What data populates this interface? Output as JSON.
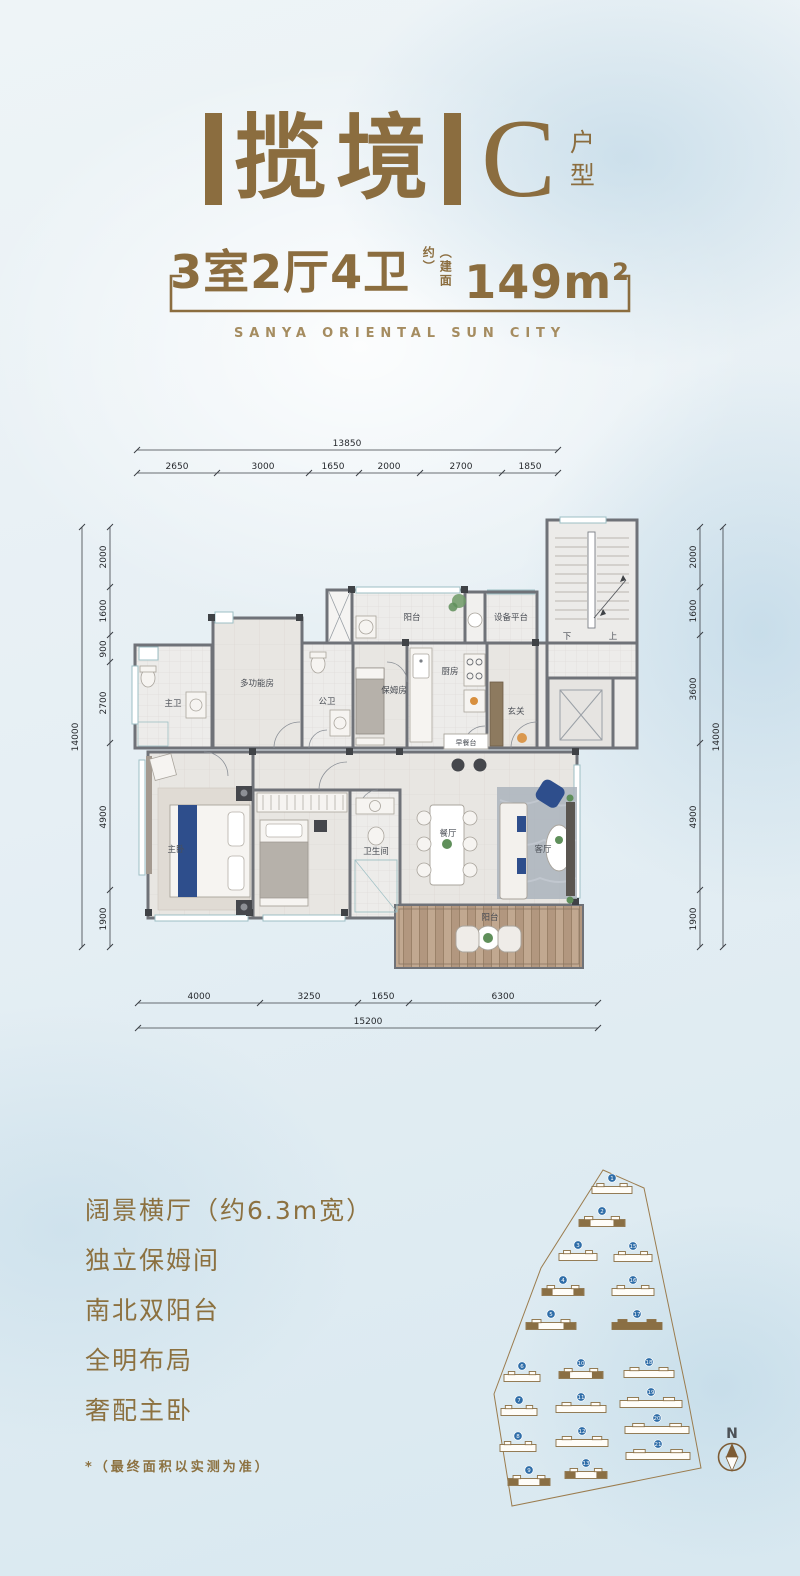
{
  "header": {
    "bracket_left": "【",
    "project_name": "揽境",
    "bracket_right": "】",
    "unit_letter": "C",
    "unit_word_top": "户",
    "unit_word_bottom": "型",
    "rooms_text": "3室2厅4卫",
    "area_note": "（建面约）",
    "area_value": "149m",
    "area_sup": "2",
    "english": "SANYA ORIENTAL SUN CITY"
  },
  "plan": {
    "dims": {
      "top_total": "13850",
      "top_segments": [
        "2650",
        "3000",
        "1650",
        "2000",
        "2700",
        "1850"
      ],
      "bottom_segments": [
        "4000",
        "3250",
        "1650",
        "6300"
      ],
      "bottom_total": "15200",
      "left_total": "14000",
      "left_segments": [
        "2000",
        "1600",
        "900",
        "2700",
        "4900",
        "1900"
      ],
      "right_total": "14000",
      "right_segments": [
        "2000",
        "1600",
        "3600",
        "4900",
        "1900"
      ]
    },
    "rooms": {
      "master_bath": "主卫",
      "multi_room": "多功能房",
      "public_bath": "公卫",
      "nanny_room": "保姆房",
      "north_balcony": "阳台",
      "equipment": "设备平台",
      "kitchen": "厨房",
      "foyer": "玄关",
      "breakfast_bar": "早餐台",
      "stairs_down": "下",
      "stairs_up": "上",
      "master_bed": "主卧",
      "bath3": "卫生间",
      "dining": "餐厅",
      "living": "客厅",
      "south_balcony": "阳台"
    }
  },
  "features": {
    "items": [
      "阔景横厅（约6.3m宽）",
      "独立保姆间",
      "南北双阳台",
      "全明布局",
      "奢配主卧"
    ],
    "footnote": "*（最终面积以实测为准）"
  },
  "siteplan": {
    "compass_label": "N",
    "boundary": [
      [
        123,
        8
      ],
      [
        164,
        26
      ],
      [
        207,
        232
      ],
      [
        221,
        306
      ],
      [
        32,
        344
      ],
      [
        14,
        232
      ],
      [
        61,
        106
      ]
    ],
    "buildings": [
      {
        "n": "1",
        "x": 132,
        "y": 28,
        "w": 40,
        "style": "outline"
      },
      {
        "n": "2",
        "x": 122,
        "y": 61,
        "w": 46,
        "style": "mixed"
      },
      {
        "n": "3",
        "x": 98,
        "y": 95,
        "w": 38,
        "style": "outline"
      },
      {
        "n": "15",
        "x": 153,
        "y": 96,
        "w": 38,
        "style": "outline"
      },
      {
        "n": "4",
        "x": 83,
        "y": 130,
        "w": 42,
        "style": "mixed"
      },
      {
        "n": "16",
        "x": 153,
        "y": 130,
        "w": 42,
        "style": "outline"
      },
      {
        "n": "5",
        "x": 71,
        "y": 164,
        "w": 50,
        "style": "mixed"
      },
      {
        "n": "17",
        "x": 157,
        "y": 164,
        "w": 50,
        "style": "filled"
      },
      {
        "n": "6",
        "x": 42,
        "y": 216,
        "w": 36,
        "style": "outline"
      },
      {
        "n": "10",
        "x": 101,
        "y": 213,
        "w": 44,
        "style": "mixed"
      },
      {
        "n": "18",
        "x": 169,
        "y": 212,
        "w": 50,
        "style": "outline"
      },
      {
        "n": "7",
        "x": 39,
        "y": 250,
        "w": 36,
        "style": "outline"
      },
      {
        "n": "11",
        "x": 101,
        "y": 247,
        "w": 50,
        "style": "outline"
      },
      {
        "n": "19",
        "x": 171,
        "y": 242,
        "w": 62,
        "style": "outline"
      },
      {
        "n": "8",
        "x": 38,
        "y": 286,
        "w": 36,
        "style": "outline"
      },
      {
        "n": "12",
        "x": 102,
        "y": 281,
        "w": 52,
        "style": "outline"
      },
      {
        "n": "20",
        "x": 177,
        "y": 268,
        "w": 64,
        "style": "outline"
      },
      {
        "n": "9",
        "x": 49,
        "y": 320,
        "w": 42,
        "style": "mixed"
      },
      {
        "n": "13",
        "x": 106,
        "y": 313,
        "w": 42,
        "style": "mixed"
      },
      {
        "n": "21",
        "x": 178,
        "y": 294,
        "w": 64,
        "style": "outline"
      }
    ]
  },
  "colors": {
    "accent_brown": "#8b6d3f",
    "badge_blue": "#2e6da8",
    "wall_gray": "#6f7278",
    "accent_navy": "#2e4e8c"
  }
}
